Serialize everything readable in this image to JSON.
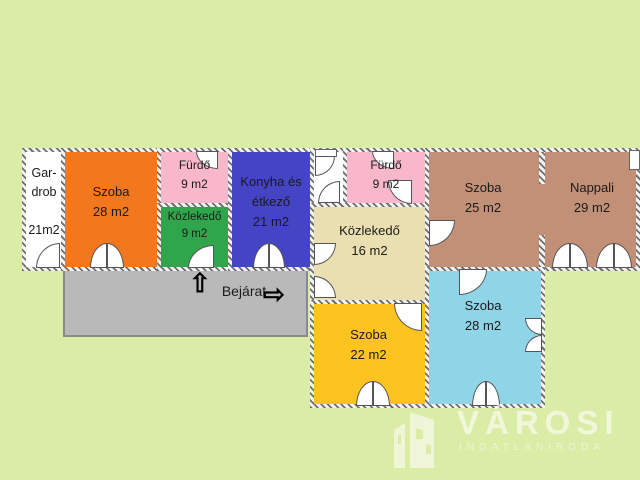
{
  "colors": {
    "background": "#dbeca6",
    "wall": "#6f6f6f",
    "terrace": "#b9b9b9",
    "text": "#1b1b1b",
    "watermark_text": "#ffffff",
    "gardrob": "#ffffff",
    "szoba_28_left": "#f3771d",
    "furdo_1": "#f8b7cb",
    "kozlekedo_9": "#2fa54c",
    "konyha": "#4444c4",
    "corridor": "#ffffff",
    "furdo_2": "#f8b7cb",
    "kozlekedo_16": "#e9dfb0",
    "szoba_25_nappali": "#c28f77",
    "szoba_22": "#fdc41f",
    "szoba_28_right": "#90d4e8"
  },
  "rooms": {
    "gardrob": {
      "line1": "Gar-",
      "line2": "drob",
      "area": "21m2"
    },
    "szoba_28_left": {
      "label": "Szoba",
      "area": "28 m2"
    },
    "furdo_1": {
      "label": "Fürdő",
      "area": "9 m2"
    },
    "kozlekedo_9": {
      "label": "Közlekedő",
      "area": "9 m2"
    },
    "konyha": {
      "line1": "Konyha és",
      "line2": "étkező",
      "area": "21 m2"
    },
    "furdo_2": {
      "label": "Fürdő",
      "area": "9 m2"
    },
    "kozlekedo_16": {
      "label": "Közlekedő",
      "area": "16 m2"
    },
    "szoba_25": {
      "label": "Szoba",
      "area": "25 m2"
    },
    "nappali": {
      "label": "Nappali",
      "area": "29 m2"
    },
    "szoba_22": {
      "label": "Szoba",
      "area": "22 m2"
    },
    "szoba_28_right": {
      "label": "Szoba",
      "area": "28 m2"
    }
  },
  "entrance": {
    "label": "Bejárat",
    "up_arrow": "⇧",
    "right_arrow": "⇨"
  },
  "watermark": {
    "brand": "VÁROSI",
    "subtitle": "INGATLANIRODA"
  }
}
